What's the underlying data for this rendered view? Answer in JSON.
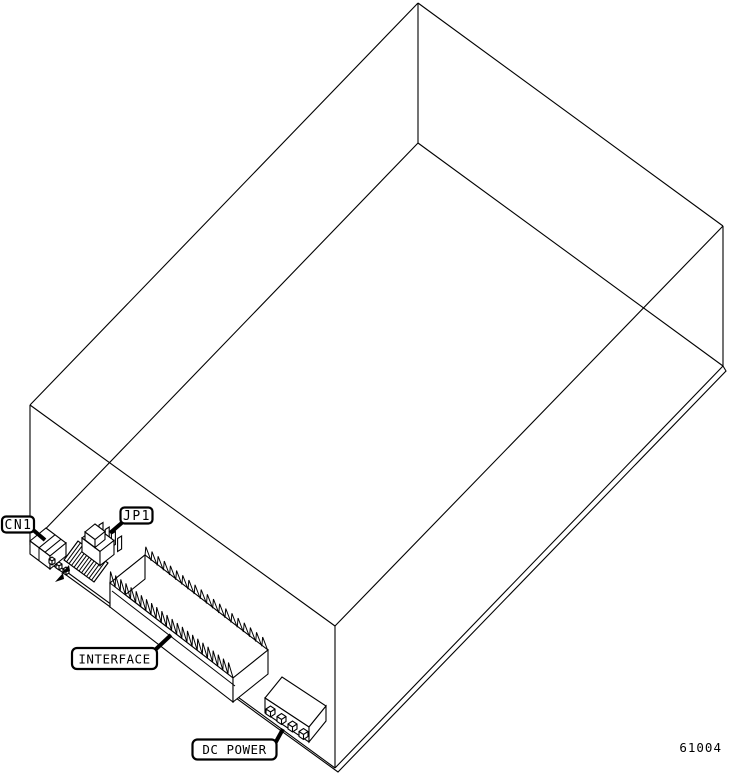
{
  "figure": {
    "kind": "isometric-technical-illustration",
    "subject": "disk drive chassis with front-edge connectors",
    "background_color": "#ffffff",
    "line_color": "#000000",
    "callouts": {
      "cn1": {
        "label": "CN1"
      },
      "jp1": {
        "label": "JP1"
      },
      "interface": {
        "label": "INTERFACE"
      },
      "dc_power": {
        "label": "DC POWER"
      }
    },
    "figure_number": "61004"
  }
}
